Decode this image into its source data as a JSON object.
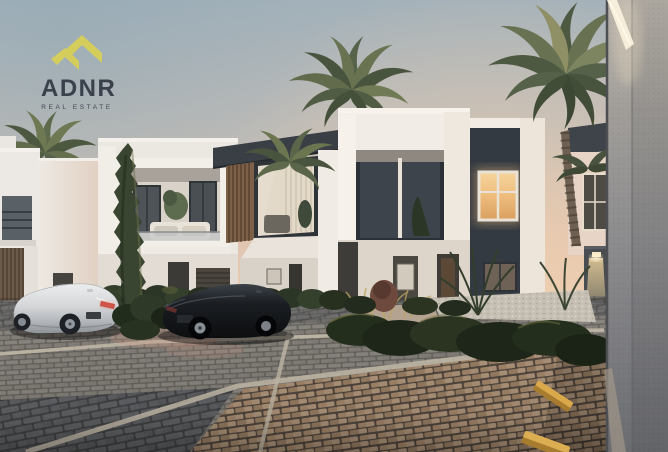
{
  "page": {
    "title": "ADNR Real Estate dusk exterior rendering of modern townhouses"
  },
  "logo": {
    "title": "ADNR",
    "subtitle": "REAL ESTATE",
    "icon": "adnr-roof-monogram-icon",
    "icon_color": "#d4cd5b",
    "title_color": "#3a414b",
    "subtitle_color": "#414851"
  },
  "scene": {
    "time_of_day": "dusk",
    "subject": "modern white townhouse row with charcoal accents, palm trees, cypress, parked cars and cobblestone parking court",
    "elements": [
      "sky",
      "townhouses",
      "wood-louver-facade",
      "lit-window",
      "balcony",
      "palm-trees",
      "cypress-tree",
      "hedges",
      "garden-bed",
      "silver-coupe",
      "black-sedan",
      "cobblestone-paving",
      "parking-lines",
      "yellow-parking-curbs",
      "foreground-concrete-wall",
      "edge-light",
      "wall-lamp"
    ],
    "colors": {
      "sky_top": "#a2b1ba",
      "sky_horizon": "#eccfb4",
      "facade_white": "#efece7",
      "accent_charcoal": "#383e45",
      "wood_louver": "#7c6148",
      "window_glow": "#eec08a",
      "foliage_dark": "#2e3a2b",
      "pavement_gray": "#86837e",
      "pavement_tan": "#a8896b",
      "curb_yellow": "#d2a044",
      "wall_gray": "#87878a"
    }
  }
}
